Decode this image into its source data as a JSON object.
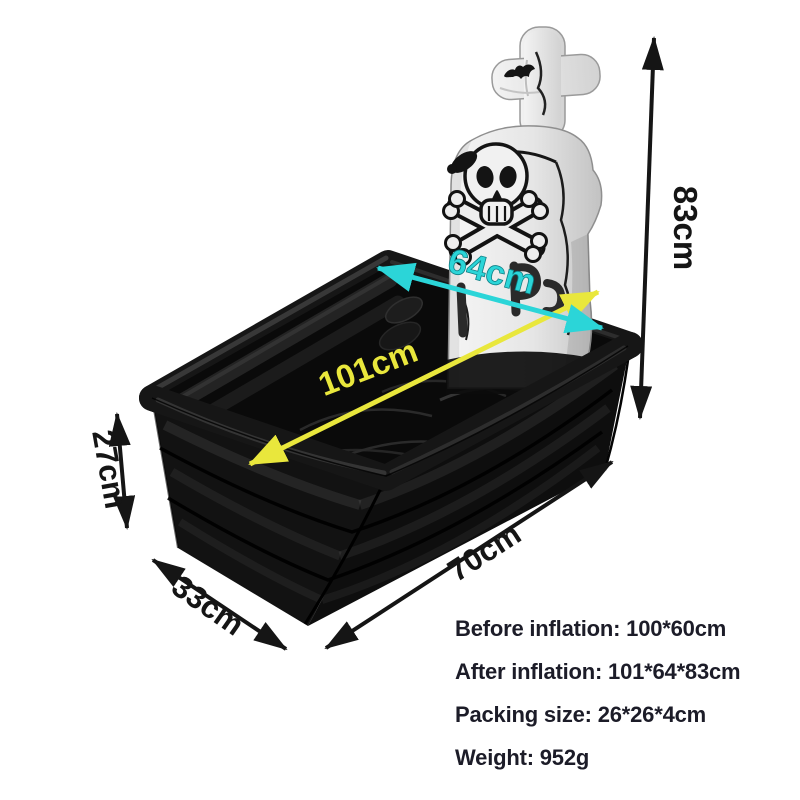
{
  "annotations": {
    "height": {
      "label": "83cm",
      "color": "#151515"
    },
    "top_length": {
      "label": "101cm",
      "color": "#e9e73c"
    },
    "top_width": {
      "label": "64cm",
      "color": "#2bd5d8"
    },
    "wall_height": {
      "label": "27cm",
      "color": "#151515"
    },
    "base_width": {
      "label": "33cm",
      "color": "#151515"
    },
    "base_length": {
      "label": "70cm",
      "color": "#151515"
    }
  },
  "specs": {
    "before_inflation": "Before inflation: 100*60cm",
    "after_inflation": "After inflation: 101*64*83cm",
    "packing_size": "Packing size: 26*26*4cm",
    "weight": "Weight: 952g"
  },
  "colors": {
    "background": "#ffffff",
    "coffin_black": "#111111",
    "tombstone_gray": "#d9d9d9",
    "arrow_black": "#151515",
    "arrow_cyan": "#2bd5d8",
    "arrow_yellow": "#e9e73c",
    "spec_text": "#1c1c28"
  }
}
